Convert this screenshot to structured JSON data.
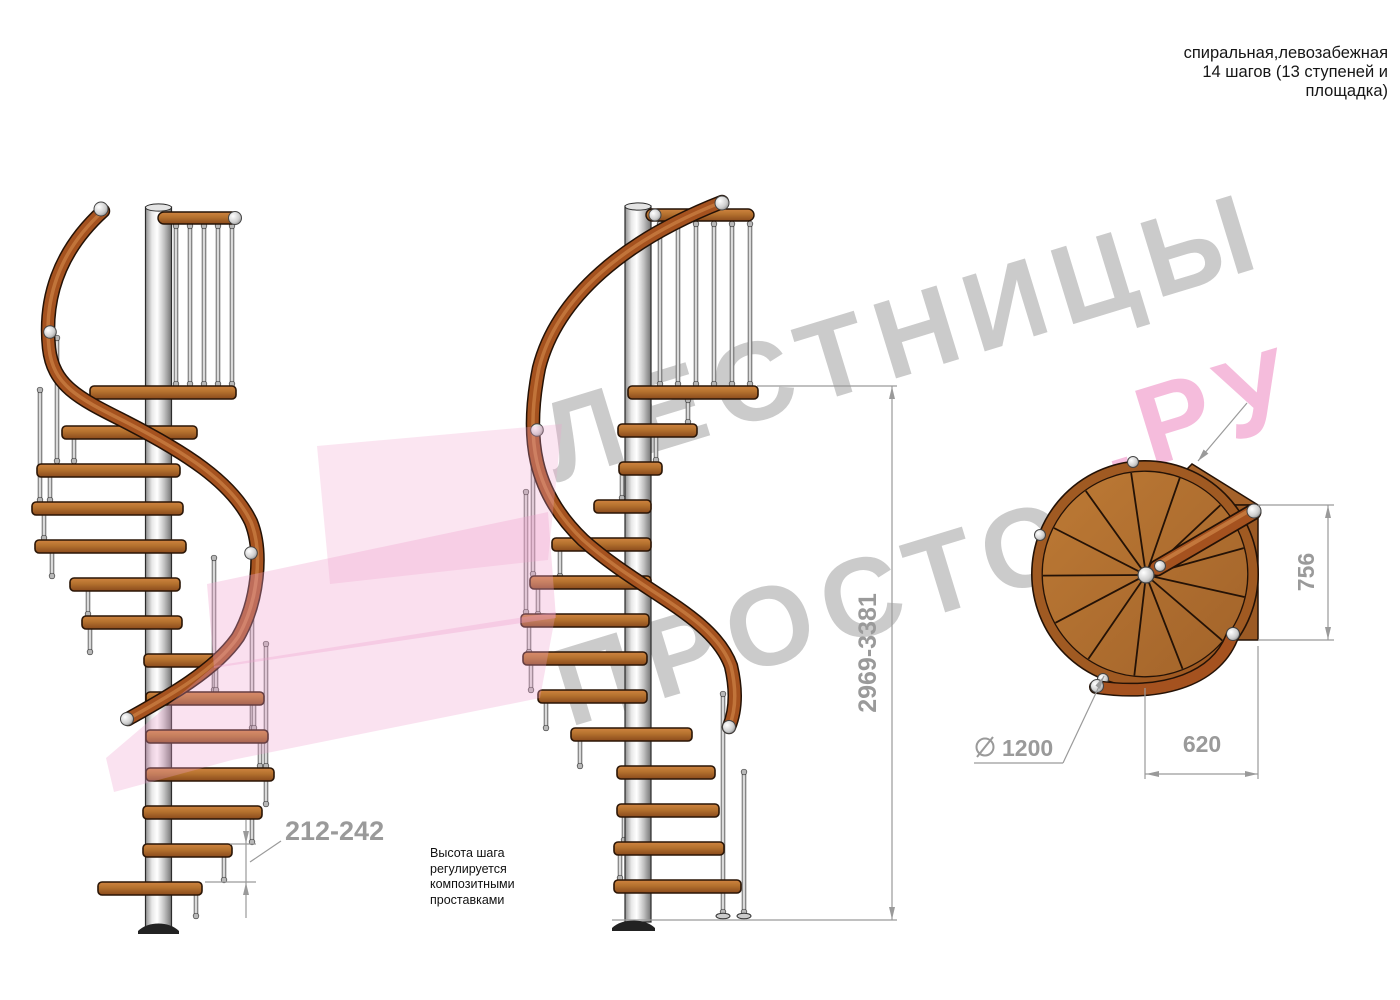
{
  "header": {
    "line1": "спиральная,левозабежная",
    "line2": "14 шагов (13 ступеней и",
    "line3": "площадка)"
  },
  "watermark": {
    "word1": "ЛЕСТНИЦЫ",
    "word2": "ПРОСТО",
    "word3": ".РУ"
  },
  "dimensions": {
    "total_height": "2969-3381",
    "step_height": "212-242",
    "diameter_value": "1200",
    "diameter_symbol": "diameter-icon",
    "platform_depth": "756",
    "platform_width": "620"
  },
  "note": {
    "line1": "Высота шага",
    "line2": "регулируется",
    "line3": "композитными",
    "line4": "проставками"
  },
  "colors": {
    "wood_mid": "#b4712e",
    "wood_dark": "#8a4a1c",
    "rail_brown": "#a5521f",
    "metal_light": "#f2f2f2",
    "metal_dark": "#8a8a8a",
    "dim_gray": "#9a9a9a",
    "label_black": "#161616",
    "watermark_gray": "#cbcbcb",
    "watermark_pink": "#f5bcdc",
    "arrow_pink": "#f0a0cc"
  }
}
